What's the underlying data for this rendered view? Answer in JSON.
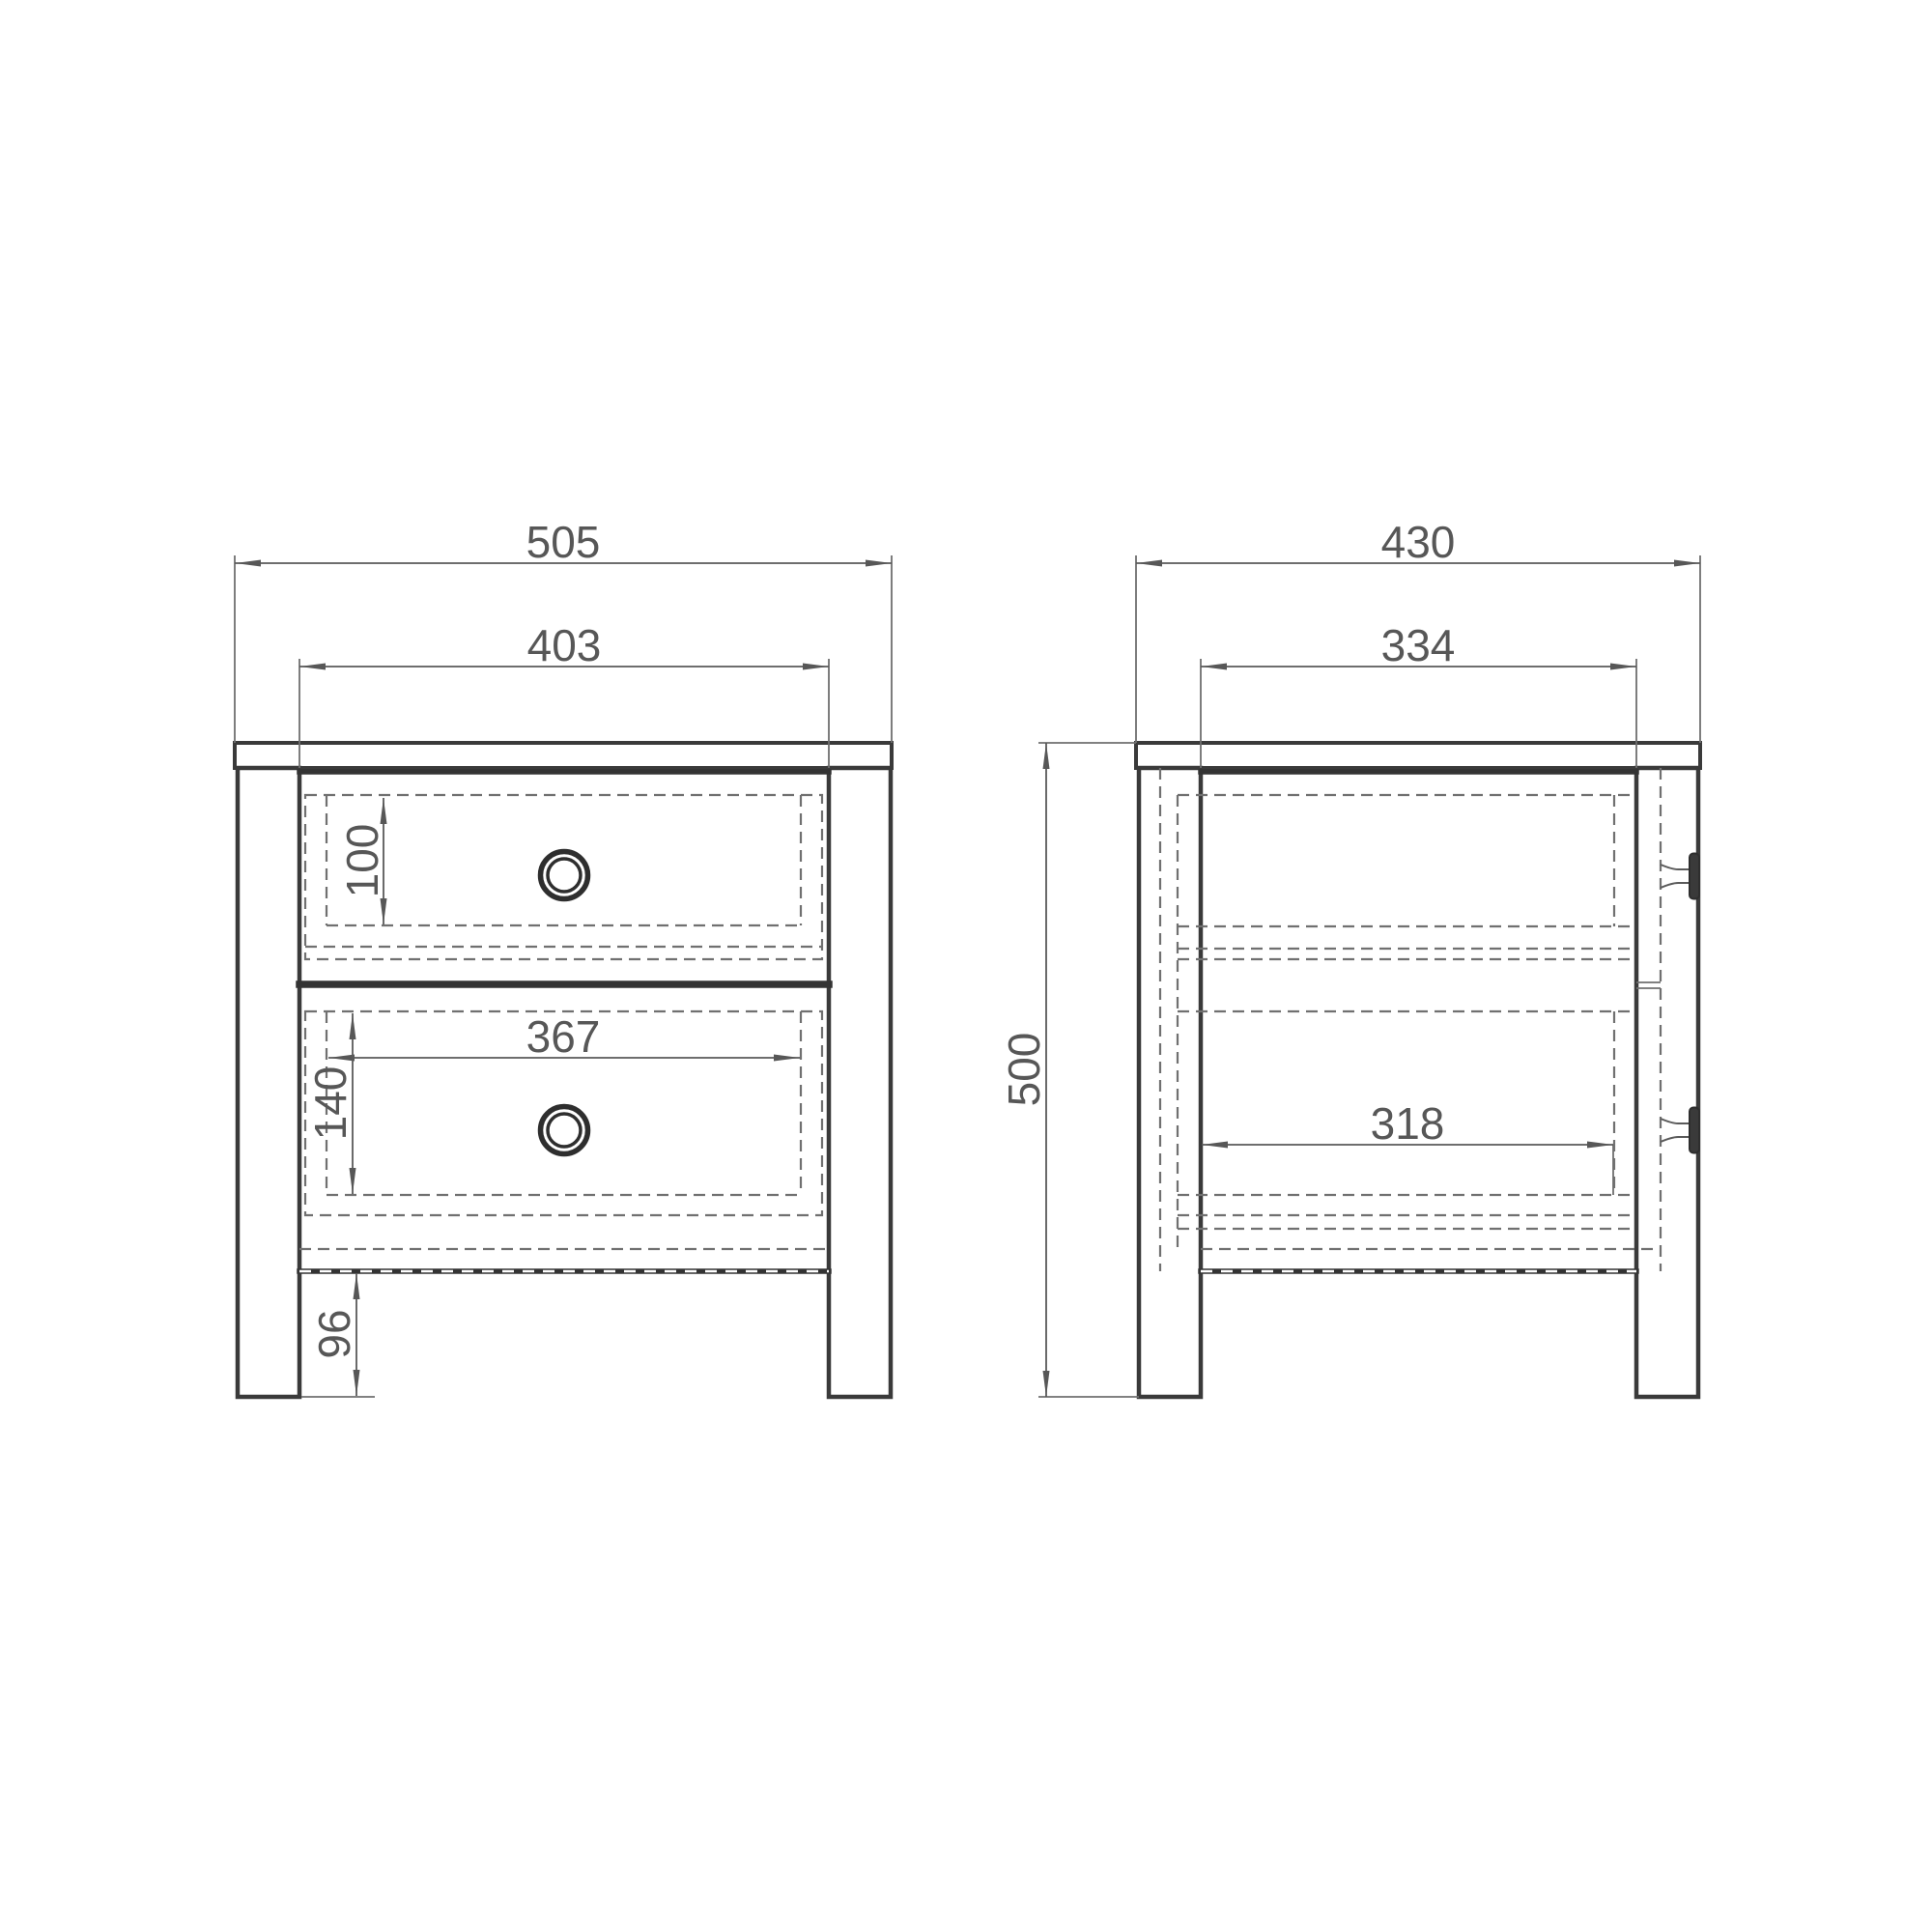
{
  "drawing": {
    "colors": {
      "background": "#ffffff",
      "outline": "#3a3a3a",
      "hidden_line": "#707070",
      "dimension": "#575757"
    },
    "front_view": {
      "dimensions": {
        "overall_width": "505",
        "inner_width": "403",
        "top_drawer_inner_height": "100",
        "bottom_drawer_inner_width": "367",
        "bottom_drawer_inner_height": "140",
        "leg_height": "96"
      }
    },
    "side_view": {
      "dimensions": {
        "overall_depth": "430",
        "inner_depth": "334",
        "overall_height": "500",
        "drawer_inner_depth": "318"
      }
    }
  }
}
